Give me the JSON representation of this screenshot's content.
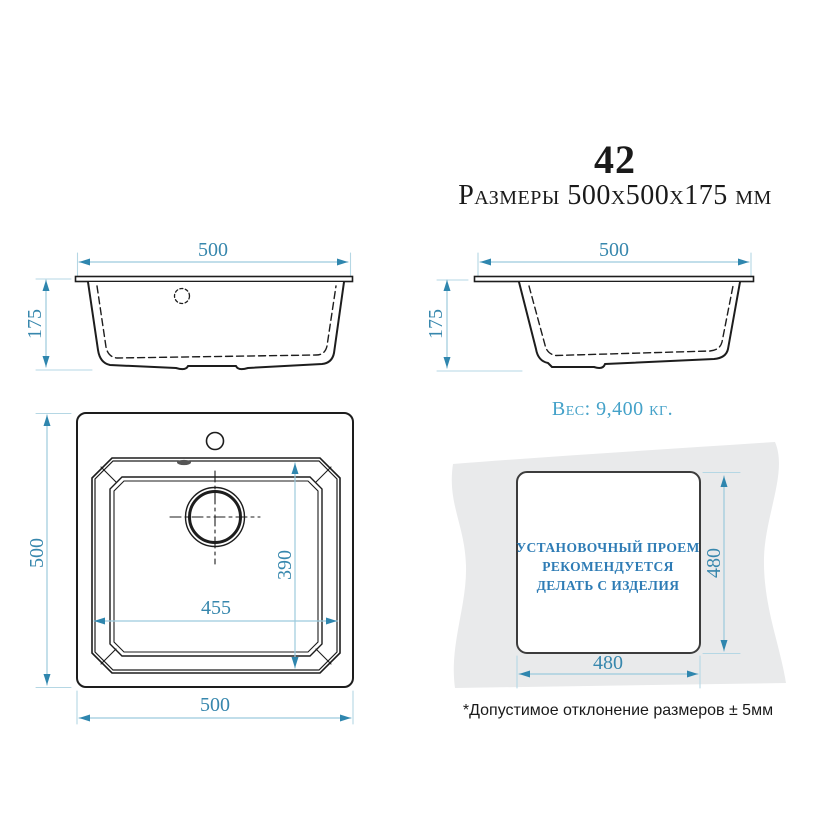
{
  "header": {
    "model": "42",
    "size_line": "Размеры 500х500х175 мм"
  },
  "front_view": {
    "width": "500",
    "height": "175"
  },
  "side_view": {
    "width": "500",
    "height": "175"
  },
  "weight_text": "Вес: 9,400 кг.",
  "top_view": {
    "overall_height": "500",
    "overall_width": "500",
    "bowl_width": "455",
    "bowl_depth": "390"
  },
  "install_view": {
    "line1": "УСТАНОВОЧНЫЙ ПРОЕМ",
    "line2": "РЕКОМЕНДУЕТСЯ",
    "line3": "ДЕЛАТЬ С ИЗДЕЛИЯ",
    "cutout_height": "480",
    "cutout_width": "480"
  },
  "footnote": "*Допустимое отклонение размеров ± 5мм",
  "colors": {
    "dimension_line": "#9ccadd",
    "extension_line": "#b5d7e4",
    "arrow": "#2f86ae",
    "dimension_text": "#3787ad",
    "drawing_line": "#1d1d1d",
    "countertop_fill": "#e9eaeb",
    "install_text": "#2e7cb5",
    "weight_text": "#45a2c9"
  }
}
